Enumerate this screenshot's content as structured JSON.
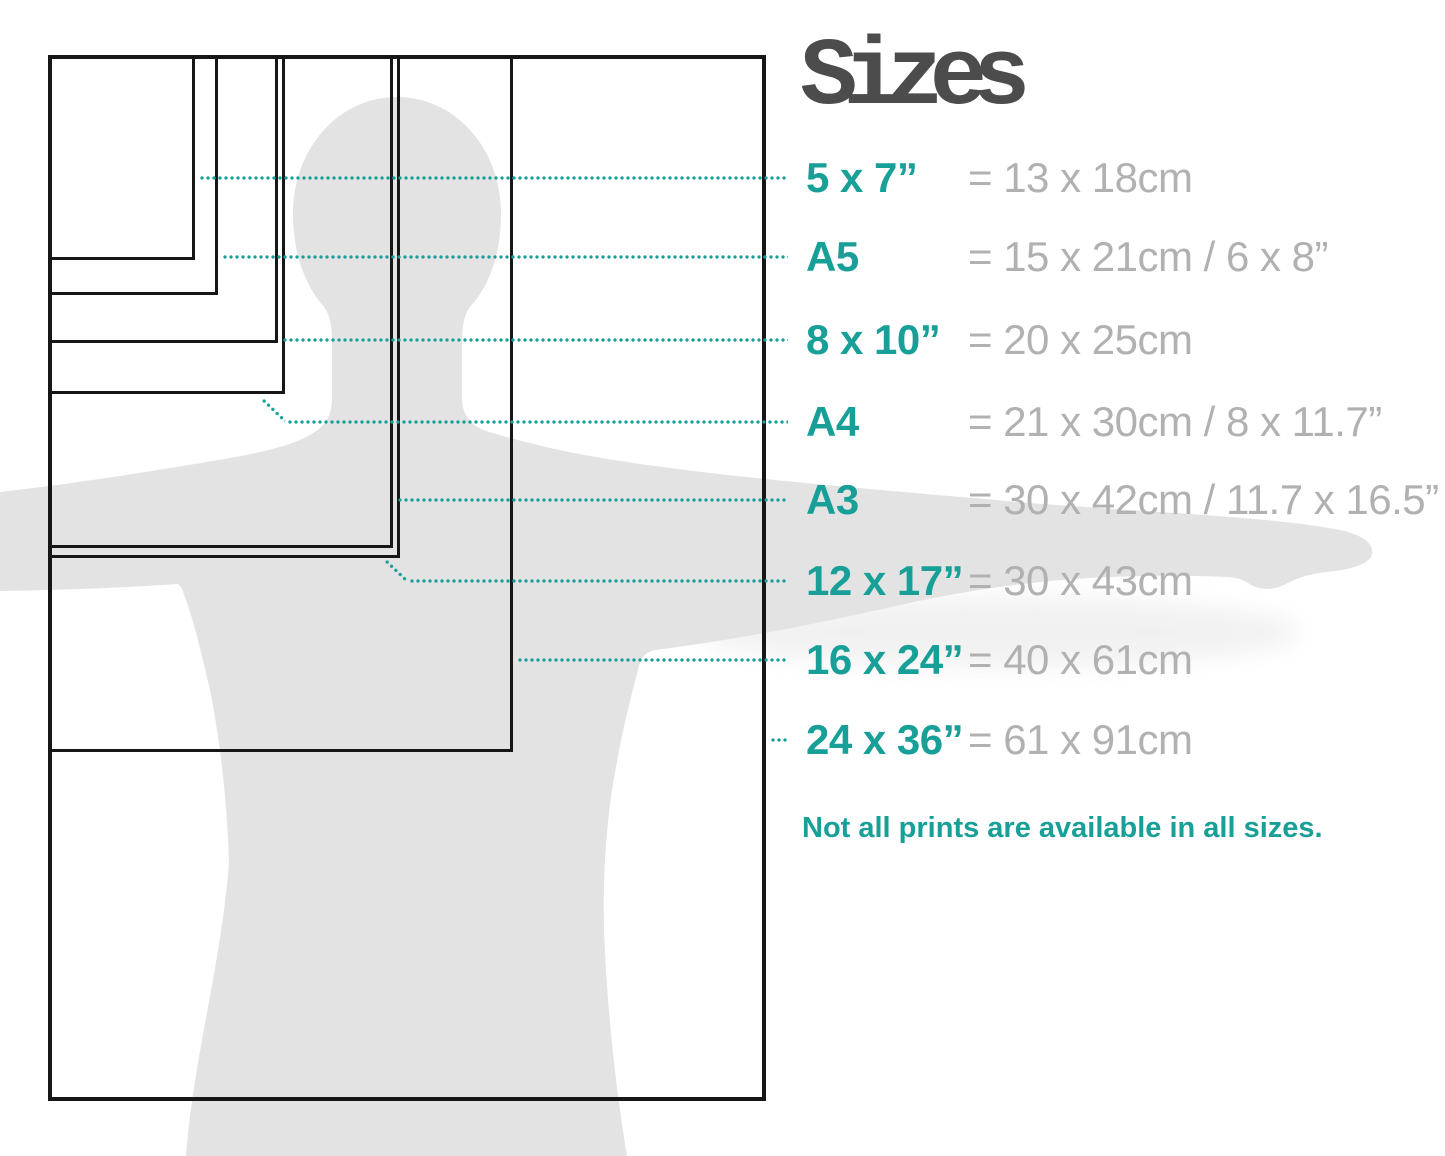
{
  "title": "Sizes",
  "note": "Not all prints are available in all sizes.",
  "colors": {
    "accent_teal": "#18a098",
    "value_gray": "#b1b1b1",
    "title_gray": "#4c4c4c",
    "frame_black": "#161616",
    "silhouette_gray": "#e3e3e3",
    "silhouette_shadow": "#e9e9e9"
  },
  "sizes": [
    {
      "id": "5x7",
      "label": "5 x 7”",
      "value": "= 13 x 18cm",
      "frame": {
        "w": 147,
        "h": 205
      },
      "row_y": 178,
      "leader": "straight"
    },
    {
      "id": "a5",
      "label": "A5",
      "value": "= 15 x 21cm / 6 x 8”",
      "frame": {
        "w": 170,
        "h": 240
      },
      "row_y": 257,
      "leader": "straight"
    },
    {
      "id": "8x10",
      "label": "8 x 10”",
      "value": "= 20 x 25cm",
      "frame": {
        "w": 230,
        "h": 288
      },
      "row_y": 340,
      "leader": "straight"
    },
    {
      "id": "a4",
      "label": "A4",
      "value": "= 21 x 30cm / 8 x 11.7”",
      "frame": {
        "w": 237,
        "h": 339
      },
      "row_y": 422,
      "leader": "elbow",
      "elbow": {
        "x1": 262,
        "y1": 399,
        "x2": 285,
        "y2": 421
      }
    },
    {
      "id": "a3",
      "label": "A3",
      "value": "= 30 x 42cm / 11.7 x 16.5”",
      "frame": {
        "w": 345,
        "h": 493
      },
      "row_y": 500,
      "leader": "straight"
    },
    {
      "id": "12x17",
      "label": "12 x 17”",
      "value": "= 30 x 43cm",
      "frame": {
        "w": 352,
        "h": 503
      },
      "row_y": 581,
      "leader": "elbow",
      "elbow": {
        "x1": 385,
        "y1": 560,
        "x2": 407,
        "y2": 581
      }
    },
    {
      "id": "16x24",
      "label": "16 x 24”",
      "value": "= 40 x 61cm",
      "frame": {
        "w": 465,
        "h": 697
      },
      "row_y": 660,
      "leader": "straight"
    },
    {
      "id": "24x36",
      "label": "24 x 36”",
      "value": "= 61 x 91cm",
      "frame": {
        "w": 718,
        "h": 1046
      },
      "row_y": 740,
      "leader": "straight"
    }
  ]
}
